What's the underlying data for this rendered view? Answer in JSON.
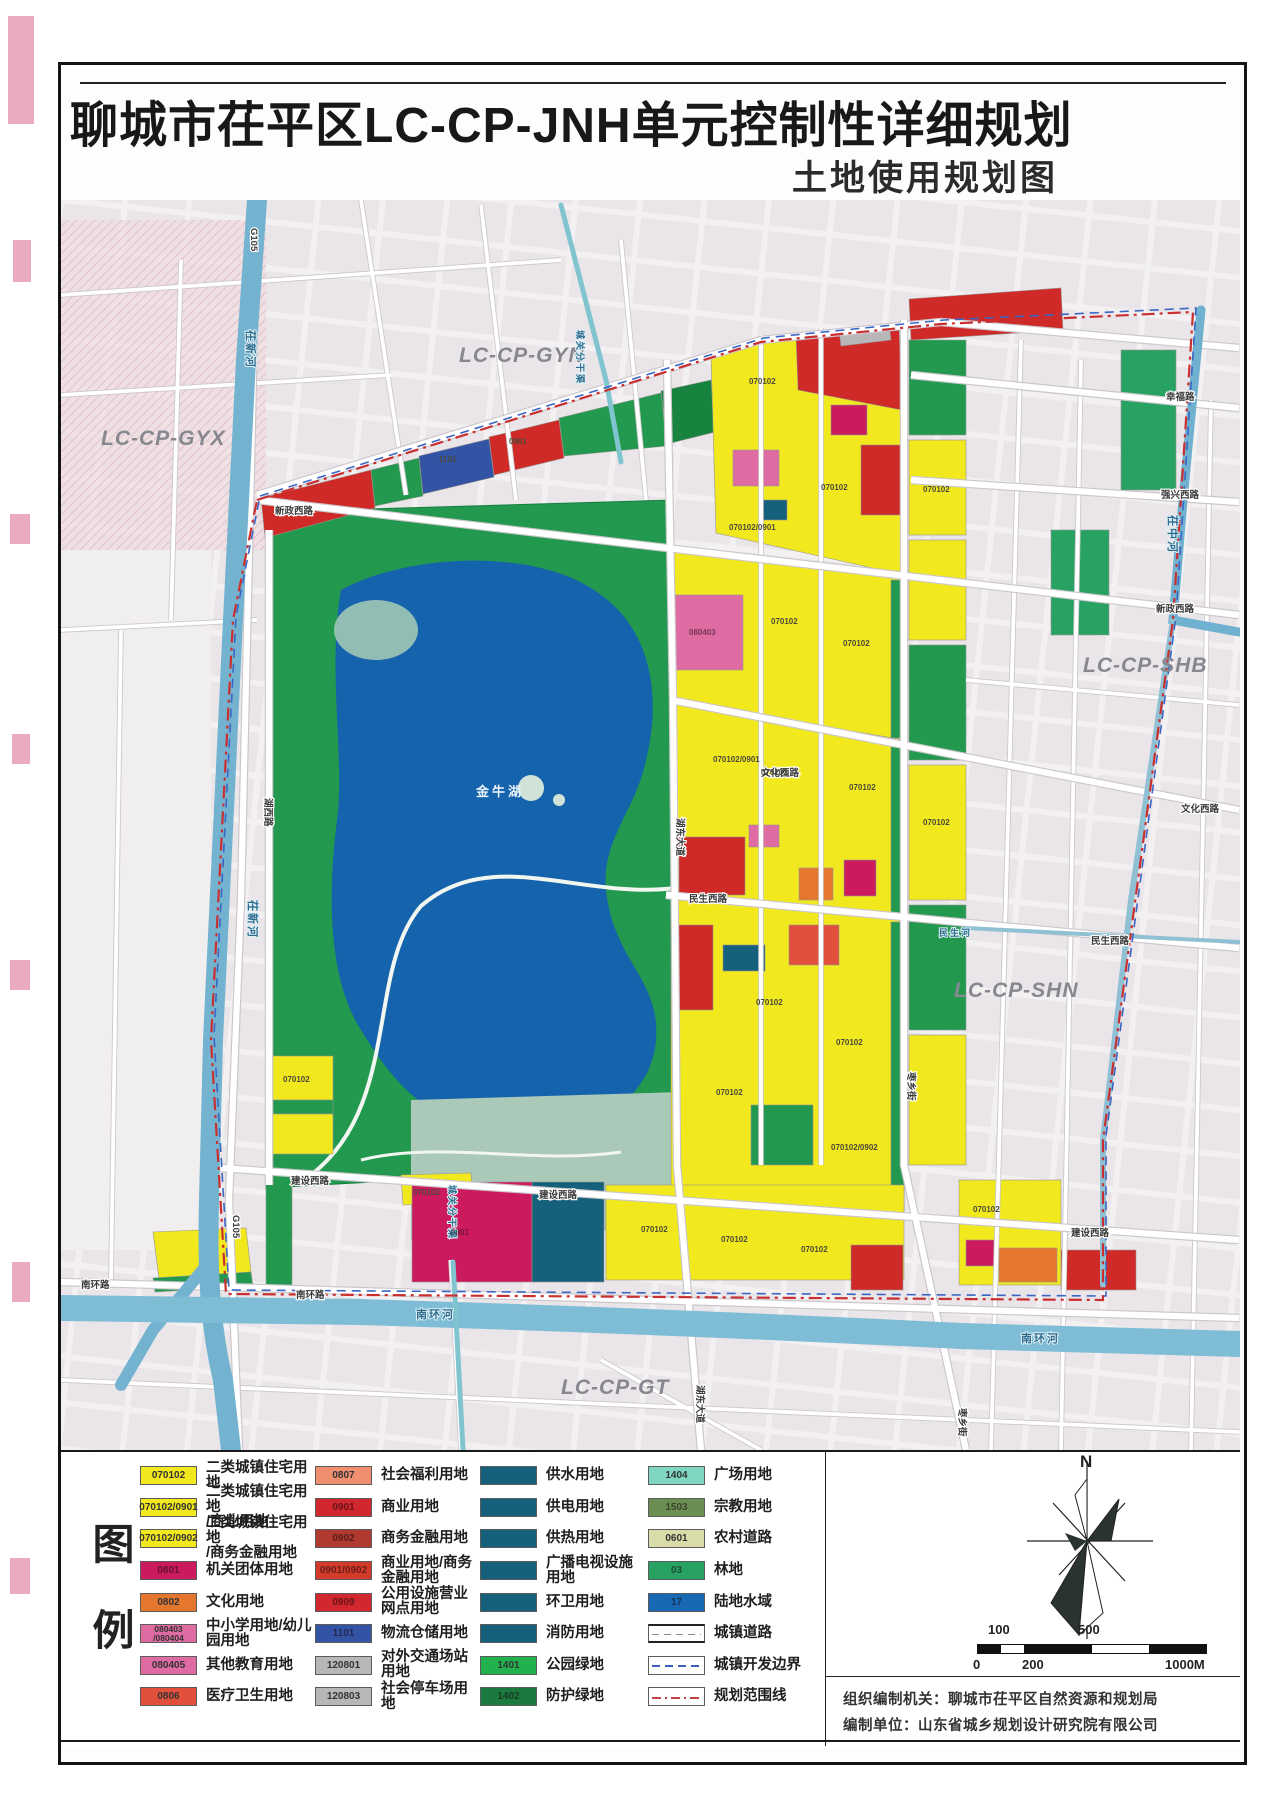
{
  "page": {
    "title": "聊城市茌平区LC-CP-JNH单元控制性详细规划",
    "subtitle": "土地使用规划图"
  },
  "map": {
    "regions": {
      "gyx": "LC-CP-GYX",
      "gyn": "LC-CP-GYN",
      "shb": "LC-CP-SHB",
      "shn": "LC-CP-SHN",
      "gt": "LC-CP-GT"
    },
    "waters": {
      "cixinhe": "茌新河",
      "cizhonghe": "茌中河",
      "nanhuanhe": "南环河",
      "minshenghe": "民生河",
      "chengguan": "城关分干渠",
      "lake": "金牛湖"
    },
    "roads": {
      "xinzheng": "新政西路",
      "wenhua": "文化西路",
      "minsheng": "民生西路",
      "jianshe": "建设西路",
      "nanhuan": "南环路",
      "hudong": "湖东大道",
      "huxi": "湖西路",
      "zaoxiang": "枣乡街",
      "g105": "G105",
      "xingfu": "幸福路",
      "qiangxing": "强兴西路"
    },
    "codes": {
      "r2": "070102",
      "r2c": "070102/0901",
      "r2f": "070102/0902",
      "gov": "0801",
      "school": "080403",
      "log": "1101",
      "com": "0901"
    }
  },
  "legend": {
    "title": "图例",
    "columns": [
      {
        "items": [
          {
            "code": "070102",
            "color": "#f2e81e",
            "label": "二类城镇住宅用地"
          },
          {
            "code": "070102/0901",
            "color": "#f2e81e",
            "label": "二类城镇住宅用地\n/商业用地"
          },
          {
            "code": "070102/0902",
            "color": "#f2e81e",
            "label": "二类城镇住宅用地\n/商务金融用地"
          },
          {
            "code": "0801",
            "color": "#cb1b5e",
            "label": "机关团体用地"
          },
          {
            "code": "0802",
            "color": "#e5762e",
            "label": "文化用地"
          },
          {
            "code": "080403\n/080404",
            "color": "#de6ba2",
            "label": "中小学用地/幼儿园用地"
          },
          {
            "code": "080405",
            "color": "#de6ba2",
            "label": "其他教育用地"
          },
          {
            "code": "0806",
            "color": "#e2503b",
            "label": "医疗卫生用地"
          }
        ]
      },
      {
        "items": [
          {
            "code": "0807",
            "color": "#ef8f70",
            "label": "社会福利用地"
          },
          {
            "code": "0901",
            "color": "#d1272e",
            "label": "商业用地"
          },
          {
            "code": "0902",
            "color": "#b03a30",
            "label": "商务金融用地"
          },
          {
            "code": "0901/0902",
            "color": "#d23b2a",
            "label": "商业用地/商务金融用地"
          },
          {
            "code": "0909",
            "color": "#d1272e",
            "label": "公用设施营业网点用地"
          },
          {
            "code": "1101",
            "color": "#3353a4",
            "label": "物流仓储用地"
          },
          {
            "code": "120801",
            "color": "#b9b6ba",
            "label": "对外交通场站用地"
          },
          {
            "code": "120803",
            "color": "#b9b6ba",
            "label": "社会停车场用地"
          }
        ]
      },
      {
        "items": [
          {
            "code": "",
            "color": "#15607a",
            "label": "供水用地"
          },
          {
            "code": "",
            "color": "#15607a",
            "label": "供电用地"
          },
          {
            "code": "",
            "color": "#15607a",
            "label": "供热用地"
          },
          {
            "code": "",
            "color": "#15607a",
            "label": "广播电视设施用地"
          },
          {
            "code": "",
            "color": "#15607a",
            "label": "环卫用地"
          },
          {
            "code": "",
            "color": "#15607a",
            "label": "消防用地"
          },
          {
            "code": "1401",
            "color": "#21b14d",
            "label": "公园绿地"
          },
          {
            "code": "1402",
            "color": "#1b7a3f",
            "label": "防护绿地"
          }
        ]
      },
      {
        "items": [
          {
            "code": "1404",
            "color": "#7fd6c2",
            "label": "广场用地"
          },
          {
            "code": "1503",
            "color": "#6b8f52",
            "label": "宗教用地"
          },
          {
            "code": "0601",
            "color": "#d9dba8",
            "label": "农村道路"
          },
          {
            "code": "03",
            "color": "#27a263",
            "label": "林地"
          },
          {
            "code": "17",
            "color": "#1968b3",
            "label": "陆地水域"
          },
          {
            "type": "road",
            "label": "城镇道路"
          },
          {
            "type": "dashed-blue",
            "label": "城镇开发边界"
          },
          {
            "type": "dashdot-red",
            "label": "规划范围线"
          }
        ]
      }
    ]
  },
  "compass": {
    "label": "N"
  },
  "scalebar": {
    "above": [
      "100",
      "500"
    ],
    "below": [
      "0",
      "200",
      "1000M"
    ]
  },
  "attribution": {
    "line1": "组织编制机关：聊城市茌平区自然资源和规划局",
    "line2": "编制单位：山东省城乡规划设计研究院有限公司"
  }
}
